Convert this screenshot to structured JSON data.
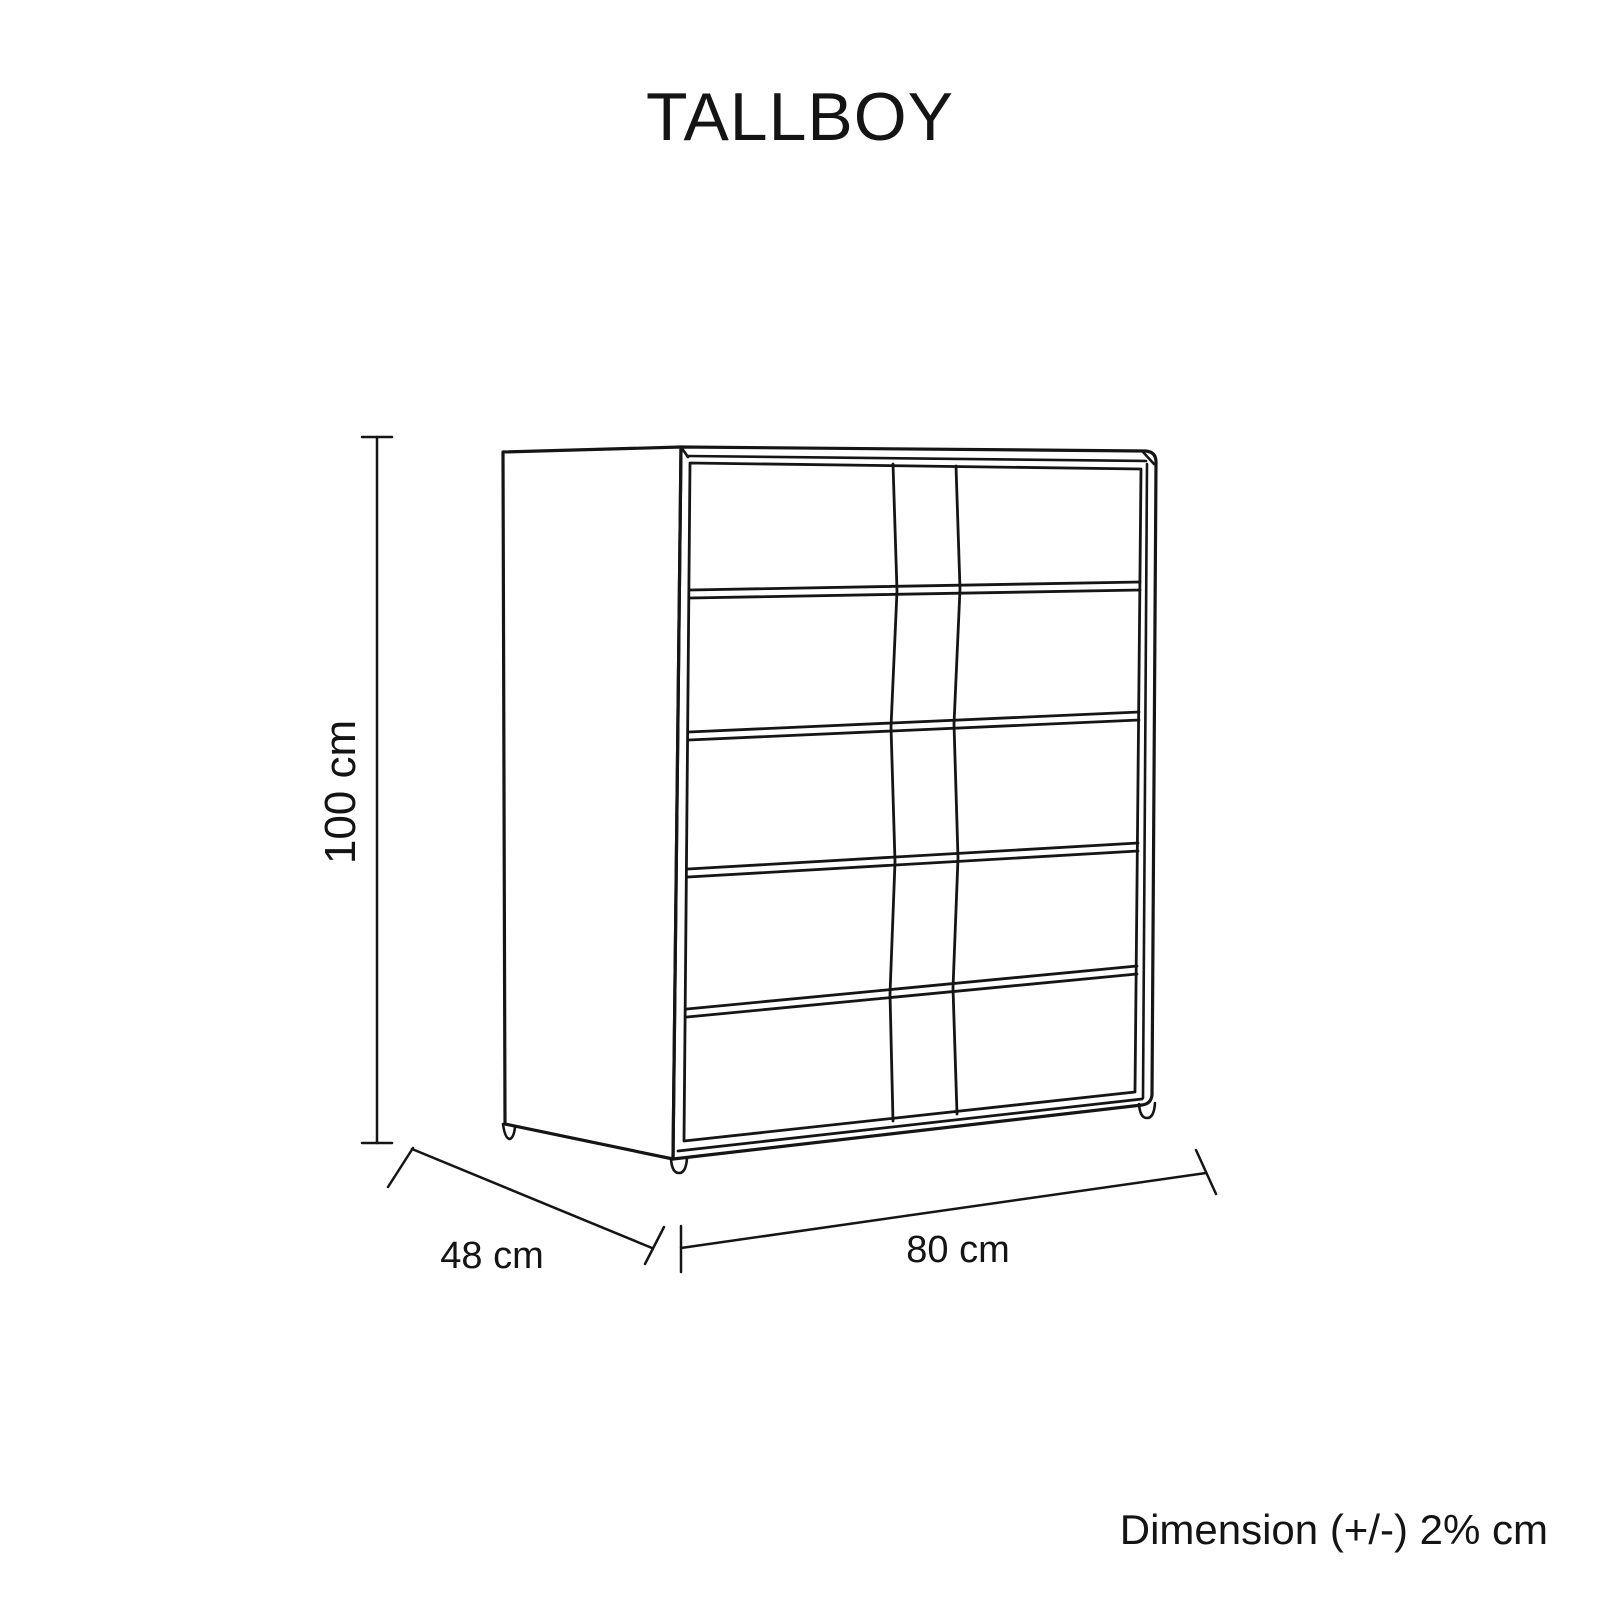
{
  "title": "TALLBOY",
  "footnote": "Dimension (+/-) 2% cm",
  "dimensions": {
    "height_label": "100 cm",
    "depth_label": "48 cm",
    "width_label": "80 cm"
  },
  "drawing": {
    "description": "5-drawer tallboy chest, perspective line drawing",
    "drawer_count": 5,
    "stroke_color": "#151515",
    "background_color": "#ffffff"
  }
}
